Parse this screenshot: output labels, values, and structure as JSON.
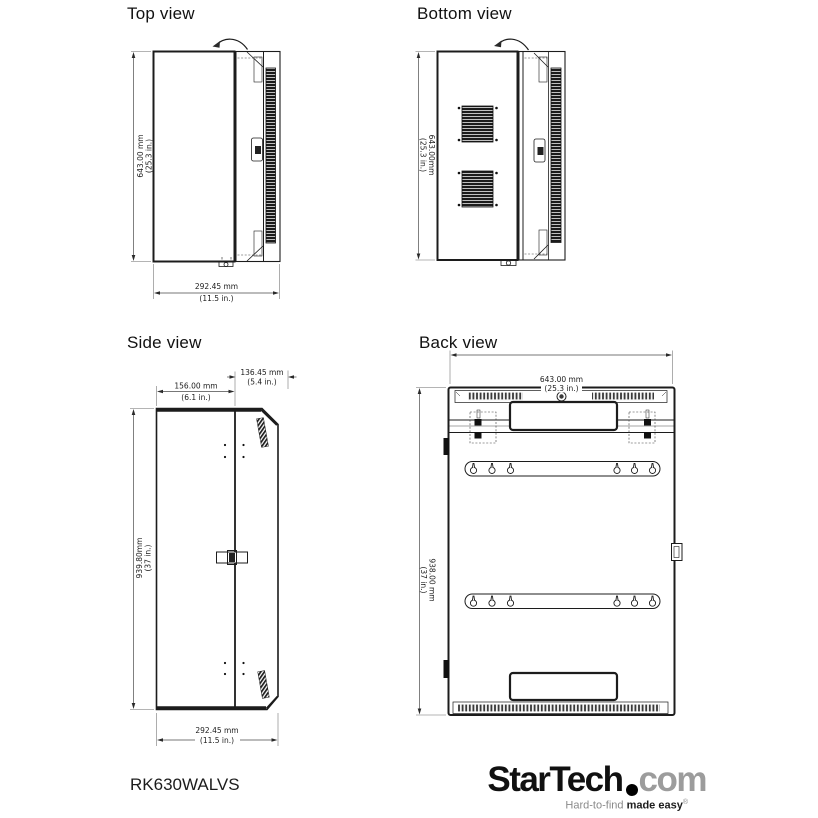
{
  "product": {
    "model": "RK630WALVS"
  },
  "views": {
    "top": {
      "title": "Top view",
      "dim_height_mm": "643.00 mm",
      "dim_height_in": "(25.3 in.)",
      "dim_depth_mm": "292.45 mm",
      "dim_depth_in": "(11.5 in.)"
    },
    "bottom": {
      "title": "Bottom view",
      "dim_height_mm": "643.00mm",
      "dim_height_in": "(25.3 in.)"
    },
    "side": {
      "title": "Side view",
      "dim_front_mm": "156.00 mm",
      "dim_front_in": "(6.1 in.)",
      "dim_rear_mm": "136.45 mm",
      "dim_rear_in": "(5.4 in.)",
      "dim_height_mm": "939.80mm",
      "dim_height_in": "(37 in.)",
      "dim_depth_mm": "292.45 mm",
      "dim_depth_in": "(11.5 in.)"
    },
    "back": {
      "title": "Back view",
      "dim_width_mm": "643.00 mm",
      "dim_width_in": "(25.3 in.)",
      "dim_height_mm": "938.00 mm",
      "dim_height_in": "(37 in.)"
    }
  },
  "branding": {
    "brand": "StarTech",
    "suffix": "com",
    "tagline_regular": "Hard-to-find ",
    "tagline_bold": "made easy",
    "registered_mark": "®"
  },
  "colors": {
    "background": "#ffffff",
    "line": "#1c1c1c",
    "dimension": "#4a4a4a",
    "logo_black": "#101010",
    "logo_gray": "#9c9c9c"
  }
}
